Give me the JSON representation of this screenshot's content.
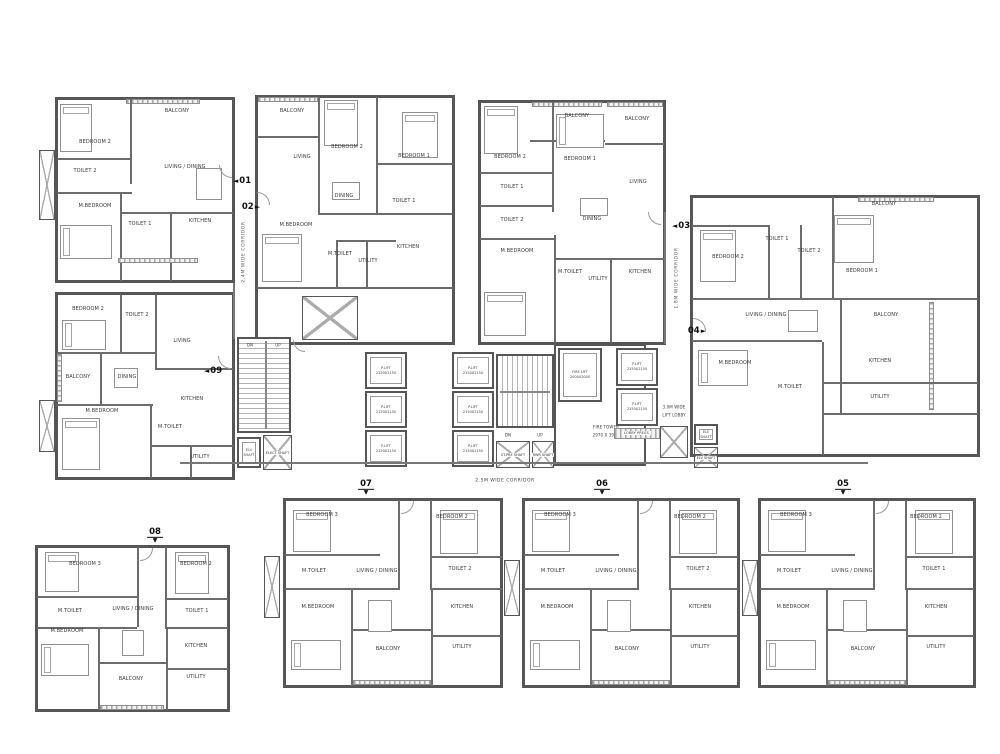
{
  "colors": {
    "wall": "#565656",
    "partition": "#6c6c6c",
    "text": "#3a3a3a",
    "hatch": "#ababab"
  },
  "corridors": {
    "left_vertical": "2.4M WIDE CORRIDOR",
    "right_vertical": "1.8M WIDE CORRIDOR",
    "bottom": "2.5M WIDE CORRIDOR",
    "lift_lobby_l1": "3.0M WIDE",
    "lift_lobby_l2": "LIFT LOBBY"
  },
  "core": {
    "stair_up": "UP",
    "stair_dn": "DN",
    "plift_name": "P.LIFT",
    "plift_size": "2150X2150",
    "fire_lift_name": "FIRE LIFT",
    "fire_lift_size": "2000X2000",
    "fire_tower_name": "FIRE TOWER",
    "fire_tower_size": "2970 X 3900",
    "elv_shaft": "ELV SHAFT",
    "elect_shaft": "ELECT SHAFT",
    "ele_shaft": "ELE SHAFT",
    "st_pre_shaft": "ST.PRE SHAFT",
    "rwr_shaft": "RWR SHAFT",
    "lobby_press": "LOBBY PRESS."
  },
  "units": [
    {
      "id": "01",
      "arrow": "◄",
      "rooms": [
        "BEDROOM 2",
        "BALCONY",
        "LIVING / DINING",
        "TOILET 2",
        "M.BEDROOM",
        "TOILET 1",
        "KITCHEN"
      ]
    },
    {
      "id": "02",
      "arrow": "►",
      "rooms": [
        "BALCONY",
        "LIVING",
        "BEDROOM 2",
        "BEDROOM 1",
        "DINING",
        "TOILET 1",
        "M.BEDROOM",
        "M.TOILET",
        "UTILITY",
        "KITCHEN"
      ]
    },
    {
      "id": "03",
      "arrow": "◄",
      "rooms": [
        "BEDROOM 2",
        "BALCONY",
        "BEDROOM 1",
        "BALCONY",
        "LIVING",
        "DINING",
        "TOILET 1",
        "TOILET 2",
        "M.BEDROOM",
        "M.TOILET",
        "UTILITY",
        "KITCHEN"
      ]
    },
    {
      "id": "04",
      "arrow": "►",
      "rooms": [
        "BALCONY",
        "TOILET 1",
        "TOILET 2",
        "BEDROOM 2",
        "BEDROOM 1",
        "LIVING / DINING",
        "BALCONY",
        "M.BEDROOM",
        "M.TOILET",
        "KITCHEN",
        "UTILITY"
      ]
    },
    {
      "id": "05",
      "arrow": "▼",
      "rooms": [
        "BEDROOM 3",
        "BEDROOM 2",
        "M.TOILET",
        "LIVING / DINING",
        "TOILET 1",
        "M.BEDROOM",
        "KITCHEN",
        "BALCONY",
        "UTILITY"
      ]
    },
    {
      "id": "06",
      "arrow": "▼",
      "rooms": [
        "BEDROOM 3",
        "BEDROOM 2",
        "M.TOILET",
        "LIVING / DINING",
        "TOILET 2",
        "M.BEDROOM",
        "KITCHEN",
        "BALCONY",
        "UTILITY"
      ]
    },
    {
      "id": "07",
      "arrow": "▼",
      "rooms": [
        "BEDROOM 3",
        "BEDROOM 2",
        "M.TOILET",
        "LIVING / DINING",
        "TOILET 2",
        "M.BEDROOM",
        "KITCHEN",
        "BALCONY",
        "UTILITY"
      ]
    },
    {
      "id": "08",
      "arrow": "▼",
      "rooms": [
        "BEDROOM 3",
        "BEDROOM 2",
        "M.TOILET",
        "LIVING / DINING",
        "TOILET 1",
        "M.BEDROOM",
        "KITCHEN",
        "BALCONY",
        "UTILITY"
      ]
    },
    {
      "id": "09",
      "arrow": "◄",
      "rooms": [
        "BEDROOM 2",
        "TOILET 2",
        "LIVING",
        "BALCONY",
        "DINING",
        "M.BEDROOM",
        "M.TOILET",
        "KITCHEN",
        "UTILITY"
      ]
    }
  ]
}
